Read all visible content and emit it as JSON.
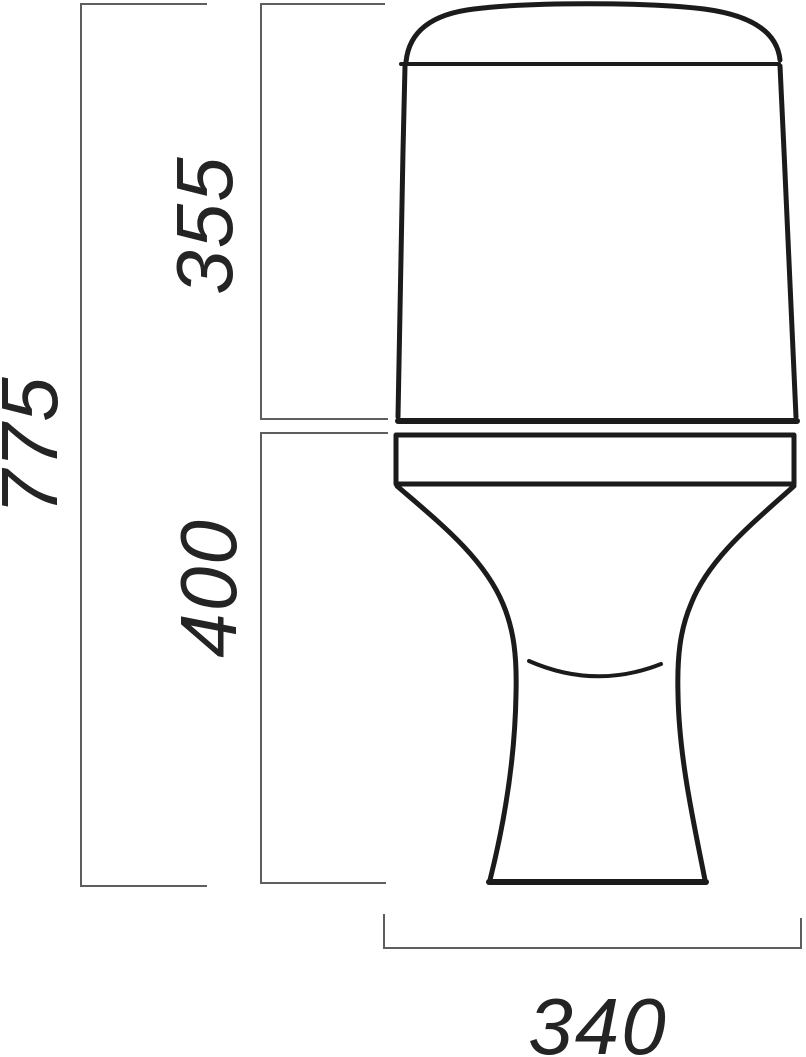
{
  "dimensions": {
    "total_height": "775",
    "tank_height": "355",
    "bowl_height": "400",
    "base_width": "340"
  },
  "colors": {
    "background": "#ffffff",
    "outline": "#1b1b1b",
    "dimension_line": "#5e5e5e",
    "label_text": "#242424"
  }
}
